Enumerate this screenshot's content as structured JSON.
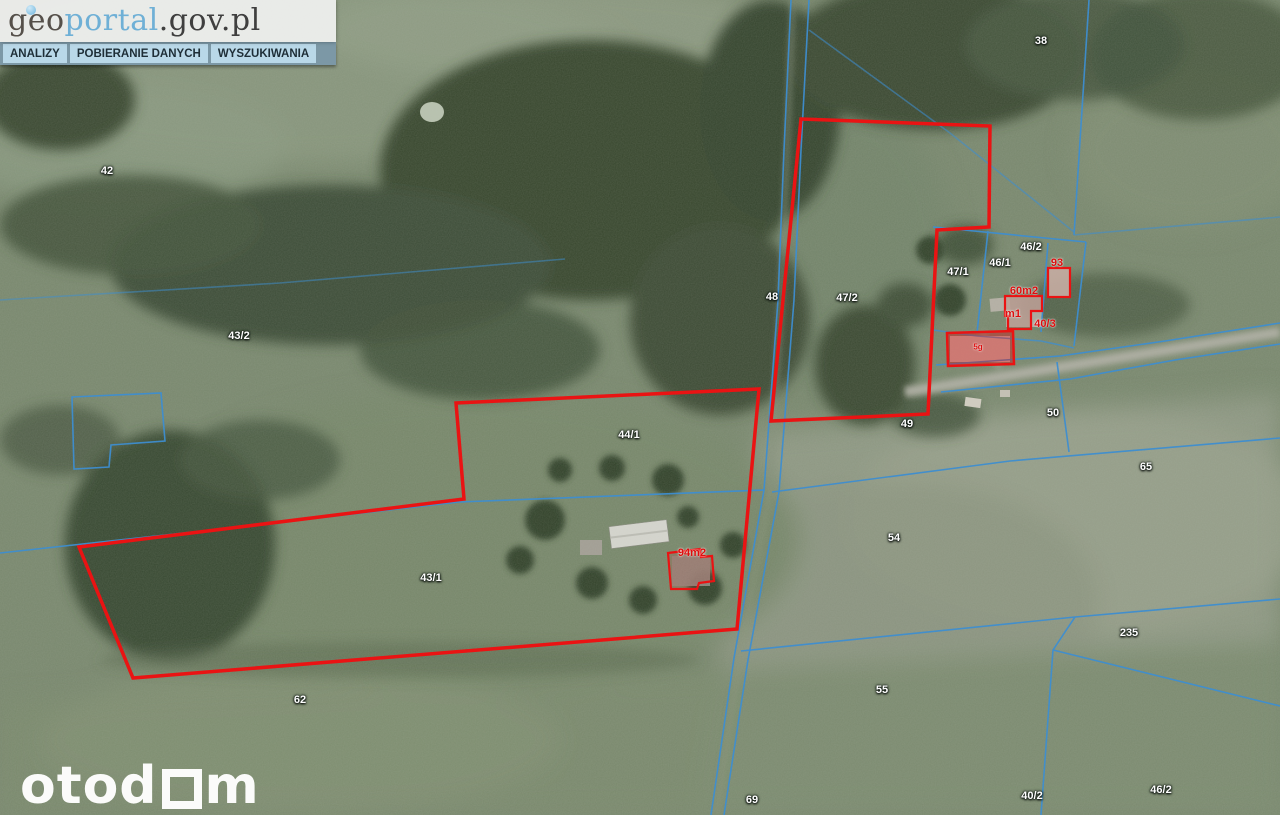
{
  "header": {
    "logo": {
      "geo": "geo",
      "portal": "portal",
      "suffix": ".gov.pl"
    },
    "menu_items": [
      {
        "label": "ANALIZY"
      },
      {
        "label": "POBIERANIE DANYCH"
      },
      {
        "label": "WYSZUKIWANIA"
      }
    ]
  },
  "watermark": {
    "prefix": "otod",
    "suffix": "m"
  },
  "map": {
    "colors": {
      "cadastral_line": "#3e8ed0",
      "highlight_red": "#ea1313",
      "label_white": "#ffffff",
      "label_red": "#dd0e0e"
    },
    "cadastral_labels": [
      {
        "text": "42",
        "x": 107,
        "y": 171
      },
      {
        "text": "43/2",
        "x": 239,
        "y": 336
      },
      {
        "text": "38",
        "x": 1041,
        "y": 41
      },
      {
        "text": "48",
        "x": 772,
        "y": 297
      },
      {
        "text": "47/2",
        "x": 847,
        "y": 298
      },
      {
        "text": "47/1",
        "x": 958,
        "y": 272
      },
      {
        "text": "46/1",
        "x": 1000,
        "y": 263
      },
      {
        "text": "46/2",
        "x": 1031,
        "y": 247
      },
      {
        "text": "44/1",
        "x": 629,
        "y": 435
      },
      {
        "text": "43/1",
        "x": 431,
        "y": 578
      },
      {
        "text": "49",
        "x": 907,
        "y": 424
      },
      {
        "text": "50",
        "x": 1053,
        "y": 413
      },
      {
        "text": "65",
        "x": 1146,
        "y": 467
      },
      {
        "text": "54",
        "x": 894,
        "y": 538
      },
      {
        "text": "55",
        "x": 882,
        "y": 690
      },
      {
        "text": "235",
        "x": 1129,
        "y": 633
      },
      {
        "text": "46/2",
        "x": 1161,
        "y": 790
      },
      {
        "text": "40/2",
        "x": 1032,
        "y": 796
      },
      {
        "text": "69",
        "x": 752,
        "y": 800
      },
      {
        "text": "62",
        "x": 300,
        "y": 700
      }
    ],
    "highlight_labels": [
      {
        "text": "93",
        "x": 1057,
        "y": 263
      },
      {
        "text": "60m2",
        "x": 1024,
        "y": 291
      },
      {
        "text": "m1",
        "x": 1013,
        "y": 314
      },
      {
        "text": "40/3",
        "x": 1045,
        "y": 324
      },
      {
        "text": "94m2",
        "x": 692,
        "y": 553
      },
      {
        "text": "5g",
        "x": 978,
        "y": 347,
        "size": 8
      }
    ]
  }
}
